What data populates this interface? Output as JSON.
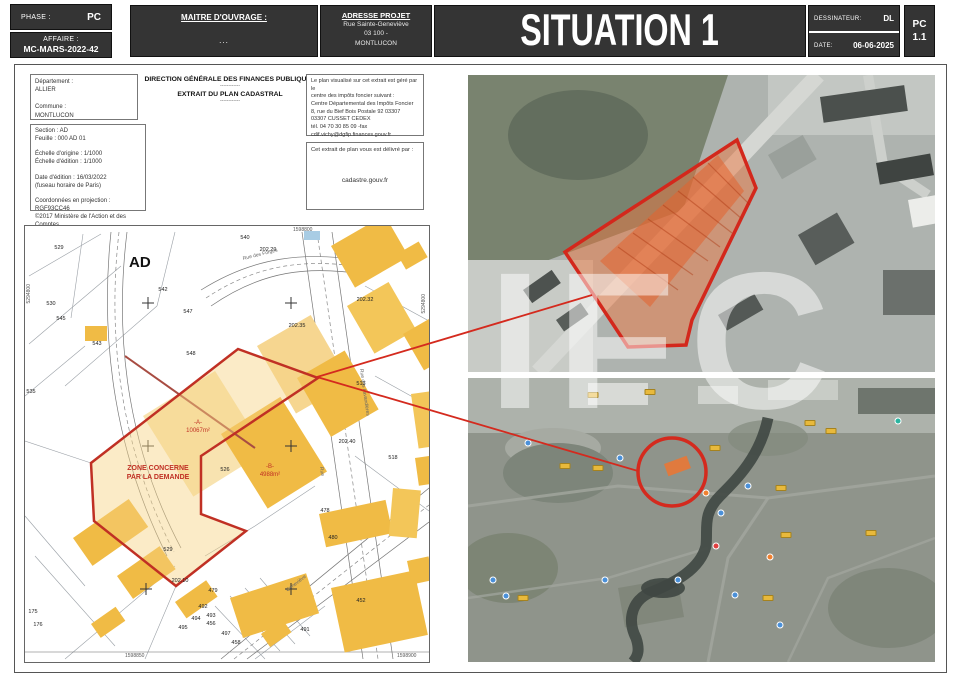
{
  "header": {
    "phase_label": "PHASE :",
    "phase_value": "PC",
    "affaire_label": "AFFAIRE :",
    "affaire_value": "MC-MARS-2022-42",
    "maitre_ouvrage_label": "MAITRE D'OUVRAGE :",
    "maitre_ouvrage_value": "...",
    "adresse_label": "ADRESSE PROJET",
    "adresse_lines": [
      "Rue Sainte-Geneviève",
      "03 100 -",
      "MONTLUCON"
    ],
    "title": "SITUATION 1",
    "dessinateur_label": "DESSINATEUR:",
    "dessinateur_value": "DL",
    "date_label": "DATE:",
    "date_value": "06-06-2025",
    "doc_code": "PC",
    "doc_number": "1.1"
  },
  "cadastre_info": {
    "agency": "DIRECTION GÉNÉRALE DES FINANCES PUBLIQUES",
    "separator": "------------",
    "subtitle": "EXTRAIT DU PLAN CADASTRAL",
    "identity_lines": [
      "Département :",
      "ALLIER",
      "",
      "Commune :",
      "MONTLUCON"
    ],
    "detail_lines": [
      "Section : AD",
      "Feuille : 000 AD 01",
      "",
      "Échelle d'origine : 1/1000",
      "Échelle d'édition : 1/1000",
      "",
      "Date d'édition : 16/03/2022",
      "(fuseau horaire de Paris)",
      "",
      "Coordonnées en projection : RGF93CC46",
      "©2017 Ministère de l'Action et des Comptes",
      "publics"
    ],
    "notice_lines": [
      "Le plan visualisé sur cet extrait est géré par le",
      "centre des impôts foncier suivant :",
      "Centre Départemental des Impôts Foncier",
      "8, rue du Bief Bois Postale 92 03307",
      "03307 CUSSET CEDEX",
      "tél. 04 70 30 85 09 -fax",
      "cdif.vichy@dgfip.finances.gouv.fr"
    ],
    "delivery_label": "Cet extrait de plan vous est délivré par :",
    "delivery_site": "cadastre.gouv.fr"
  },
  "map": {
    "section_label": "AD",
    "zone_line1": "ZONE CONCERNE",
    "zone_line2": "PAR LA DEMANDE",
    "parcel_a_name": "-A-",
    "parcel_a_area": "10067m²",
    "parcel_b_name": "-B-",
    "parcel_b_area": "4988m²",
    "coord_top": "1598800",
    "coord_bottom_left": "1598850",
    "coord_bottom_right": "1598900",
    "coord_left": "5294800",
    "coord_right": "5294800",
    "parcels": [
      {
        "label": "529",
        "x": 34,
        "y": 22
      },
      {
        "label": "540",
        "x": 220,
        "y": 12
      },
      {
        "label": "202.29",
        "x": 243,
        "y": 24
      },
      {
        "label": "542",
        "x": 138,
        "y": 64
      },
      {
        "label": "547",
        "x": 163,
        "y": 86
      },
      {
        "label": "543",
        "x": 72,
        "y": 118
      },
      {
        "label": "548",
        "x": 166,
        "y": 128
      },
      {
        "label": "530",
        "x": 26,
        "y": 78
      },
      {
        "label": "545",
        "x": 36,
        "y": 93
      },
      {
        "label": "535",
        "x": 6,
        "y": 166
      },
      {
        "label": "526",
        "x": 200,
        "y": 244
      },
      {
        "label": "529",
        "x": 143,
        "y": 324
      },
      {
        "label": "513",
        "x": 336,
        "y": 158
      },
      {
        "label": "518",
        "x": 368,
        "y": 232
      },
      {
        "label": "202.32",
        "x": 340,
        "y": 74
      },
      {
        "label": "202.35",
        "x": 272,
        "y": 100
      },
      {
        "label": "202.40",
        "x": 322,
        "y": 216
      },
      {
        "label": "202.10",
        "x": 155,
        "y": 355
      },
      {
        "label": "479",
        "x": 188,
        "y": 365
      },
      {
        "label": "492",
        "x": 178,
        "y": 381
      },
      {
        "label": "494",
        "x": 171,
        "y": 393
      },
      {
        "label": "495",
        "x": 158,
        "y": 402
      },
      {
        "label": "456",
        "x": 186,
        "y": 398
      },
      {
        "label": "497",
        "x": 201,
        "y": 408
      },
      {
        "label": "458",
        "x": 211,
        "y": 417
      },
      {
        "label": "478",
        "x": 300,
        "y": 285
      },
      {
        "label": "480",
        "x": 308,
        "y": 312
      },
      {
        "label": "452",
        "x": 336,
        "y": 375
      },
      {
        "label": "491",
        "x": 280,
        "y": 404
      },
      {
        "label": "493",
        "x": 186,
        "y": 390
      },
      {
        "label": "175",
        "x": 8,
        "y": 386
      },
      {
        "label": "176",
        "x": 13,
        "y": 399
      }
    ],
    "streets": [
      {
        "label": "Rue des Forges",
        "x": 218,
        "y": 30,
        "rot": -14
      },
      {
        "label": "Rue des Lavandières",
        "x": 336,
        "y": 140,
        "rot": 82
      },
      {
        "label": "Rue",
        "x": 296,
        "y": 238,
        "rot": 82
      },
      {
        "label": "Geneviève",
        "x": 262,
        "y": 362,
        "rot": -38
      }
    ]
  },
  "photos": {
    "bottom": {
      "pins": [
        {
          "type": "yellow",
          "x": 125,
          "y": 17
        },
        {
          "type": "yellow",
          "x": 182,
          "y": 14
        },
        {
          "type": "yellow",
          "x": 342,
          "y": 45
        },
        {
          "type": "yellow",
          "x": 363,
          "y": 53
        },
        {
          "type": "yellow",
          "x": 97,
          "y": 88
        },
        {
          "type": "yellow",
          "x": 130,
          "y": 90
        },
        {
          "type": "yellow",
          "x": 313,
          "y": 110
        },
        {
          "type": "yellow",
          "x": 318,
          "y": 157
        },
        {
          "type": "yellow",
          "x": 55,
          "y": 220
        },
        {
          "type": "yellow",
          "x": 300,
          "y": 220
        },
        {
          "type": "yellow",
          "x": 403,
          "y": 155
        },
        {
          "type": "yellow",
          "x": 247,
          "y": 70
        },
        {
          "type": "blue",
          "x": 60,
          "y": 65
        },
        {
          "type": "blue",
          "x": 152,
          "y": 80
        },
        {
          "type": "blue",
          "x": 280,
          "y": 108
        },
        {
          "type": "blue",
          "x": 253,
          "y": 135
        },
        {
          "type": "blue",
          "x": 210,
          "y": 202
        },
        {
          "type": "blue",
          "x": 267,
          "y": 217
        },
        {
          "type": "blue",
          "x": 312,
          "y": 247
        },
        {
          "type": "blue",
          "x": 25,
          "y": 202
        },
        {
          "type": "blue",
          "x": 38,
          "y": 218
        },
        {
          "type": "blue",
          "x": 137,
          "y": 202
        },
        {
          "type": "teal",
          "x": 430,
          "y": 43
        },
        {
          "type": "orange",
          "x": 238,
          "y": 115
        },
        {
          "type": "orange",
          "x": 302,
          "y": 179
        },
        {
          "type": "red",
          "x": 248,
          "y": 168
        }
      ]
    }
  },
  "watermark": "IFC",
  "colors": {
    "header_bg": "#343434",
    "zone_red": "#c03024",
    "building_yellow": "#f0bb45",
    "zone_fill": "#f7d282"
  }
}
